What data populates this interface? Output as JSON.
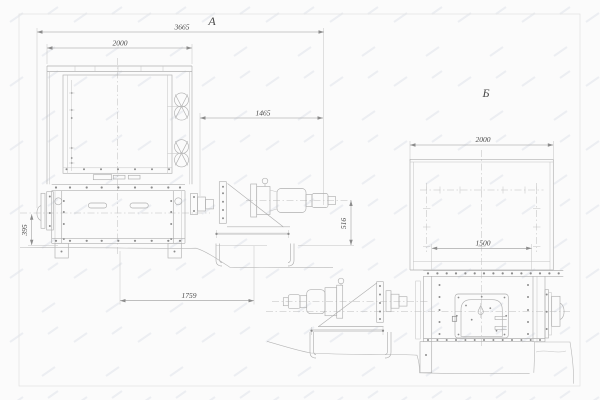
{
  "view_a": {
    "label": "А",
    "dim_overall_length": "3665",
    "dim_casing_width": "2000",
    "dim_drive_length": "1465",
    "dim_axis_height": "395",
    "dim_base_length": "1759",
    "dim_motor_axis_height": "516"
  },
  "view_b": {
    "label": "Б",
    "dim_casing_width": "2000",
    "dim_trough_length": "1500"
  },
  "colors": {
    "background": "#fbfbfb",
    "geometry_line": "#b0b0b0",
    "detail_line": "#8c8c8c",
    "dimension_line": "#9a9a9a",
    "centerline": "#bdbdbd",
    "text": "#4a4a4a",
    "frame": "#e4e4e4"
  }
}
